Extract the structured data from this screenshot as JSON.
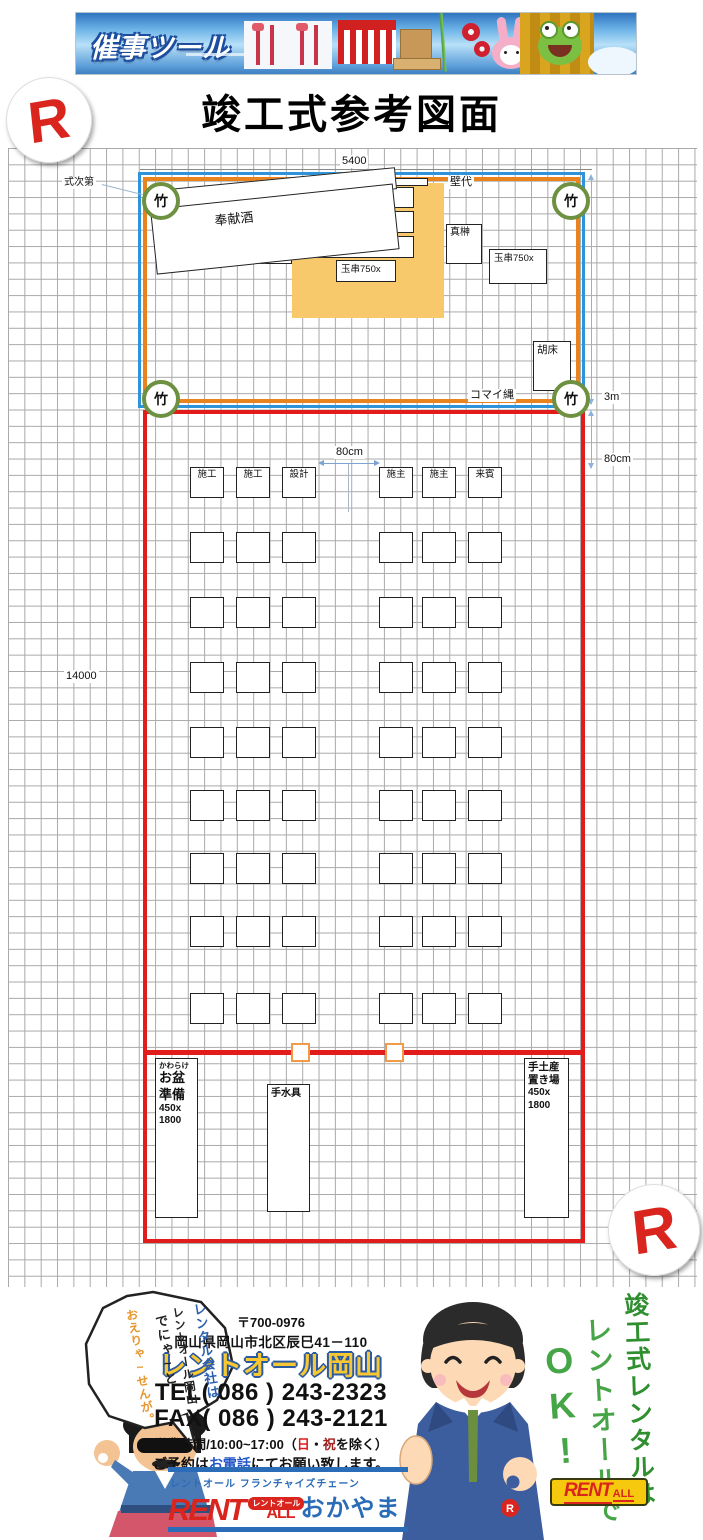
{
  "colors": {
    "accent_red": "#e21b1b",
    "accent_blue": "#2e93d8",
    "accent_orange": "#e8831d",
    "altar_tan": "#f7c96b",
    "bamboo_green": "#6d9140",
    "brand_yellow": "#f6c80e",
    "brand_red": "#d9251d",
    "brand_blue": "#2b6cb8",
    "slogan_green": "#46a546"
  },
  "banner": {
    "title": "催事ツール"
  },
  "page_title": "竣工式参考図面",
  "r_logo": "R",
  "diagram": {
    "dim_top": "5400",
    "dim_left": "14000",
    "dim_right_3m": "3m",
    "dim_right_80": "80cm",
    "dim_center_80": "80cm",
    "labels": {
      "shikishidai": "式次第",
      "kabeshiro": "壁代",
      "bamboo": "竹",
      "houkenshu": "奉献酒",
      "makomo": "真菰",
      "saidan": "祭壇W1200x250",
      "masakaki": "真榊",
      "tamagushi": "玉串750x",
      "kosho": "胡床",
      "komainawa": "コマイ縄"
    },
    "seats": {
      "row1_labels": [
        "施工",
        "施工",
        "設計",
        "施主",
        "施主",
        "来賓"
      ],
      "plain_rows": 8,
      "cols": 6
    },
    "stations": {
      "kawarake_lines": [
        "かわらけ",
        "お盆",
        "準備",
        "450x",
        "1800"
      ],
      "chouzu": "手水具",
      "temiyage_lines": [
        "手土産",
        "置き場",
        "450x",
        "1800"
      ]
    }
  },
  "footer": {
    "bubble": [
      "レンタル会社は",
      "レントオール岡山",
      "でにゃ~と",
      "おえりゃ~せんが。"
    ],
    "postal": "〒700-0976",
    "address": "岡山県岡山市北区辰巳41－110",
    "company": "レントオール岡山",
    "tel": "TEL( 086 ) 243-2323",
    "fax": "FAX( 086 ) 243-2121",
    "hours": {
      "prefix": "営業時間/10:00~17:00（",
      "sun": "日",
      "sep": "・",
      "hol": "祝",
      "suffix": "を除く）"
    },
    "reserve": {
      "prefix": "ご予約は",
      "phone": "お電話",
      "suffix": "にてお願い致します。"
    },
    "franchise_label": "レントオール フランチャイズチェーン",
    "brand": {
      "rent": "RENT",
      "all": "ALL",
      "badge": "レントオール",
      "okayama": "おかやま"
    },
    "slogan": {
      "line1": "竣工式レンタルは",
      "line2": "レントオールで",
      "line3": "OK!"
    },
    "small_logo": {
      "rent": "RENT",
      "all": "ALL"
    }
  }
}
